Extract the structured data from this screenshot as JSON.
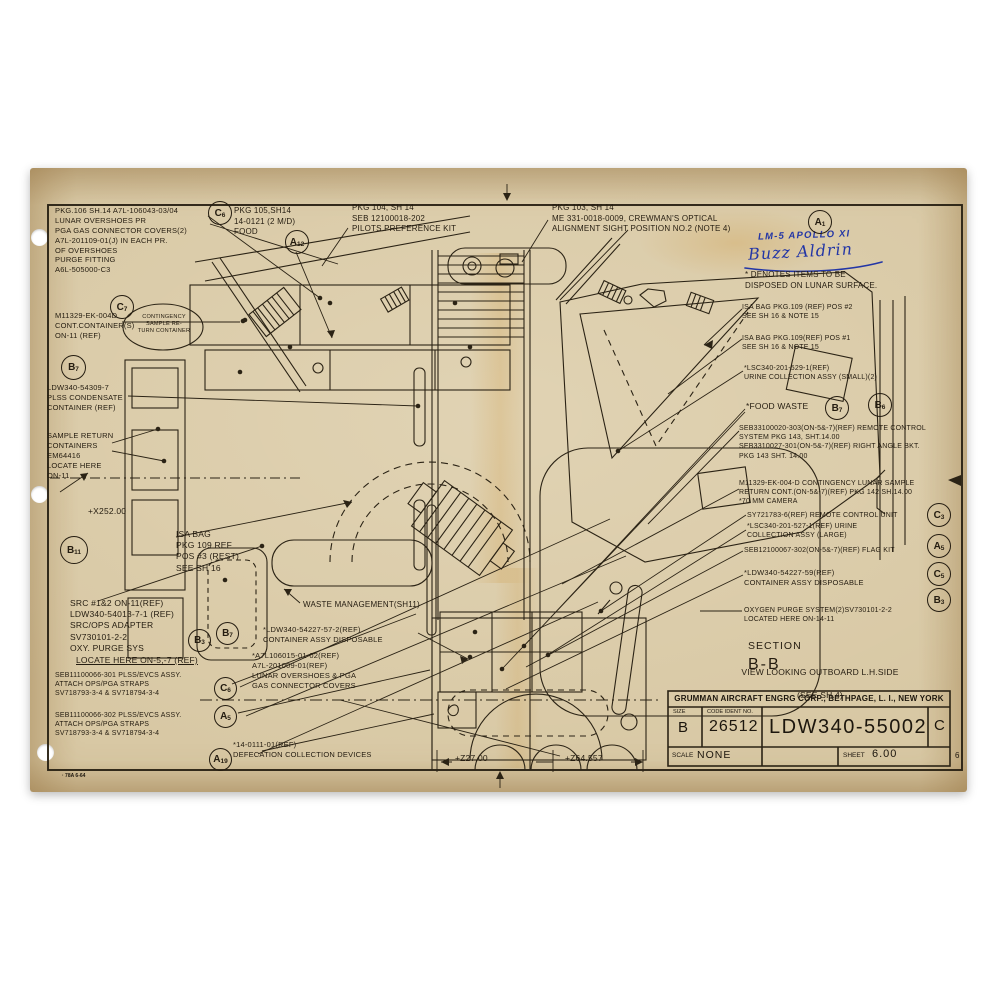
{
  "document": {
    "form_stamp": "· 78A  6-64",
    "corner_mark": "6"
  },
  "handwriting": {
    "line1": "LM-5  APOLLO XI",
    "signature": "Buzz Aldrin"
  },
  "notes": {
    "pkg106": "PKG.106 SH.14 A7L-106043-03/04\nLUNAR OVERSHOES PR\nPGA GAS CONNECTOR COVERS(2)\nA7L-201109-01(J) IN EACH PR.\nOF OVERSHOES\nPURGE FITTING\nA6L-505000-C3",
    "pkg105": "PKG 105,SH14\n14-0121 (2 M/D)\nFOOD",
    "pkg104": "PKG 104, SH 14\nSEB 12100018-202\nPILOTS PREFERENCE KIT",
    "pkg103": "PKG 103, SH 14\nME 331-0018-0009, CREWMAN'S OPTICAL\nALIGNMENT SIGHT  POSITION NO.2 (NOTE 4)",
    "denotes": "* DENOTES ITEMS TO BE\nDISPOSED ON LUNAR SURFACE.",
    "contingency_bubble": "CONTINGENCY\nSAMPLE RE-\nTURN CONTAINER",
    "m11329_left": "M11329-EK-004D\nCONT.CONTAINER(S)\nON-11 (REF)",
    "plss_condensate": "LDW340-54309-7\nPLSS CONDENSATE\nCONTAINER (REF)",
    "sample_return": "SAMPLE RETURN\nCONTAINERS\nEM64416\nLOCATE HERE\nON-11",
    "isa_pos3": "ISA BAG\nPKG 109 REF\nPOS #3 (REST)\nSEE SH 16",
    "src_block": "SRC #1&2 ON-11(REF)\nLDW340-54013-7-1 (REF)\nSRC/OPS ADAPTER\nSV730101-2-2\nOXY. PURGE SYS",
    "src_locate": "LOCATE HERE ON-5,-7 (REF)",
    "seb301": "SEB11100066-301 PLSS/EVCS ASSY.\nATTACH OPS/PGA STRAPS\nSV718793-3-4 & SV718794-3-4",
    "seb302": "SEB11100066-302 PLSS/EVCS ASSY.\nATTACH OPS/PGA STRAPS\nSV718793-3-4 & SV718794-3-4",
    "defecation": "*14-0111-01(REF)\nDEFECATION COLLECTION DEVICES",
    "waste_mgmt": "WASTE MANAGEMENT(SH11)",
    "container_disposable_left": "*LDW340-54227-57-2(REF)\nCONTAINER ASSY DISPOSABLE",
    "overshoes_center": "*A7L106015-01-02(REF)\nA7L-201009-01(REF)\nLUNAR OVERSHOES & PGA\nGAS CONNECTOR COVERS",
    "isa_pos2": "ISA BAG  PKG.109 (REF) POS #2\nSEE SH 16 & NOTE 15",
    "isa_pos1": "ISA BAG PKG.109(REF) POS #1\nSEE SH 16 & NOTE 15",
    "urine_small": "*LSC340-201-529-1(REF)\nURINE COLLECTION ASSY (SMALL)(2)",
    "food_waste": "*FOOD WASTE",
    "remote_control": "SEB33100020-303(ON-5&-7)(REF) REMOTE CONTROL\nSYSTEM PKG 143, SHT.14.00\nSEB3310027-301(ON-5&-7)(REF) RIGHT ANGLE BKT.\nPKG 143 SHT. 14.00",
    "contingency_right": "M11329-EK-004-D CONTINGENCY LUNAR SAMPLE\nRETURN CONT.(ON-5&-7)(REF) PKG 142  SH.14.00\n*70 MM CAMERA",
    "remote_unit": "SY721783-6(REF) REMOTE CONTROL UNIT",
    "urine_large": "*LSC340-201-527-1(REF) URINE\nCOLLECTION ASSY (LARGE)",
    "flag_kit": "SEB12100067-302(ON-5&-7)(REF) FLAG KIT",
    "container_disposable_right": "*LDW340-54227-59(REF)\nCONTAINER ASSY DISPOSABLE",
    "oxygen_purge": "OXYGEN PURGE SYSTEM(2)SV730101-2-2\nLOCATED HERE ON-14-11"
  },
  "dimensions": {
    "x252": "+X252.00",
    "z27": "+Z27.00",
    "z64": "+Z64.557"
  },
  "section": {
    "label": "SECTION",
    "id": "B-B",
    "view": "VIEW LOOKING OUTBOARD L.H.SIDE",
    "see": "(SEE SH.4)"
  },
  "title_block": {
    "company": "GRUMMAN AIRCRAFT ENGRG CORP., BETHPAGE, L. I., NEW YORK",
    "size_label": "SIZE",
    "size_value": "B",
    "code_label": "CODE IDENT NO.",
    "code_value": "26512",
    "drawing_number": "LDW340-55002",
    "revision": "C",
    "scale_label": "SCALE",
    "scale_value": "NONE",
    "sheet_label": "SHEET",
    "sheet_value": "6.00"
  },
  "callouts": {
    "c6_top": {
      "l": "C",
      "s": "6"
    },
    "a12": {
      "l": "A",
      "s": "12"
    },
    "a1": {
      "l": "A",
      "s": "1"
    },
    "c7": {
      "l": "C",
      "s": "7"
    },
    "b7_left": {
      "l": "B",
      "s": "7"
    },
    "b11": {
      "l": "B",
      "s": "11"
    },
    "b3_mid": {
      "l": "B",
      "s": "3"
    },
    "b7_mid": {
      "l": "B",
      "s": "7"
    },
    "c6_low": {
      "l": "C",
      "s": "6"
    },
    "a5_low": {
      "l": "A",
      "s": "5"
    },
    "a19": {
      "l": "A",
      "s": "19"
    },
    "b7_right": {
      "l": "B",
      "s": "7"
    },
    "b6_right": {
      "l": "B",
      "s": "6"
    },
    "c3": {
      "l": "C",
      "s": "3"
    },
    "a5_right": {
      "l": "A",
      "s": "5"
    },
    "c5": {
      "l": "C",
      "s": "5"
    },
    "b3_right": {
      "l": "B",
      "s": "3"
    }
  }
}
